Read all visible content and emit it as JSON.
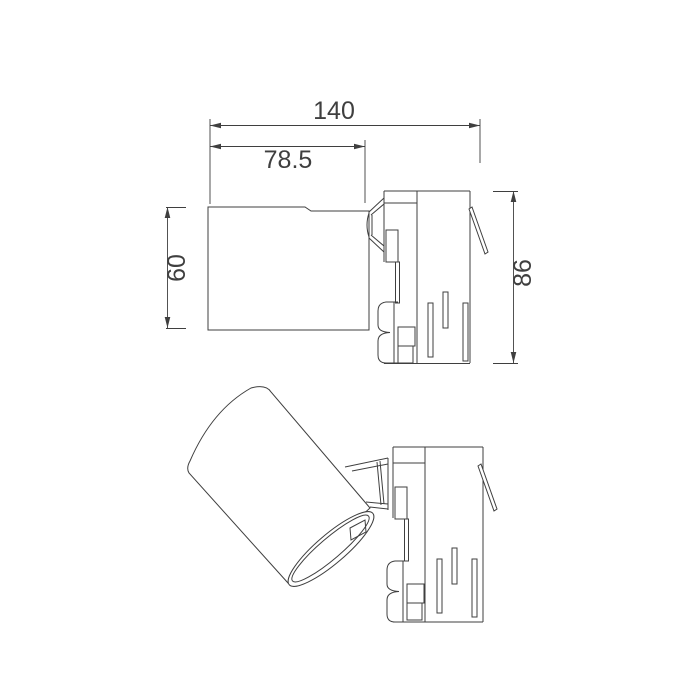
{
  "page": {
    "background_color": "#ffffff"
  },
  "drawing": {
    "kind": "dimensioned-technical-drawing",
    "subject": "track light spotlight fixture with track adapter, straight and tilted head views",
    "line_color": "#3f3f3f",
    "dimension_labels": {
      "overall_length": "140",
      "head_length": "78.5",
      "head_diameter": "60",
      "total_height": "86"
    }
  }
}
